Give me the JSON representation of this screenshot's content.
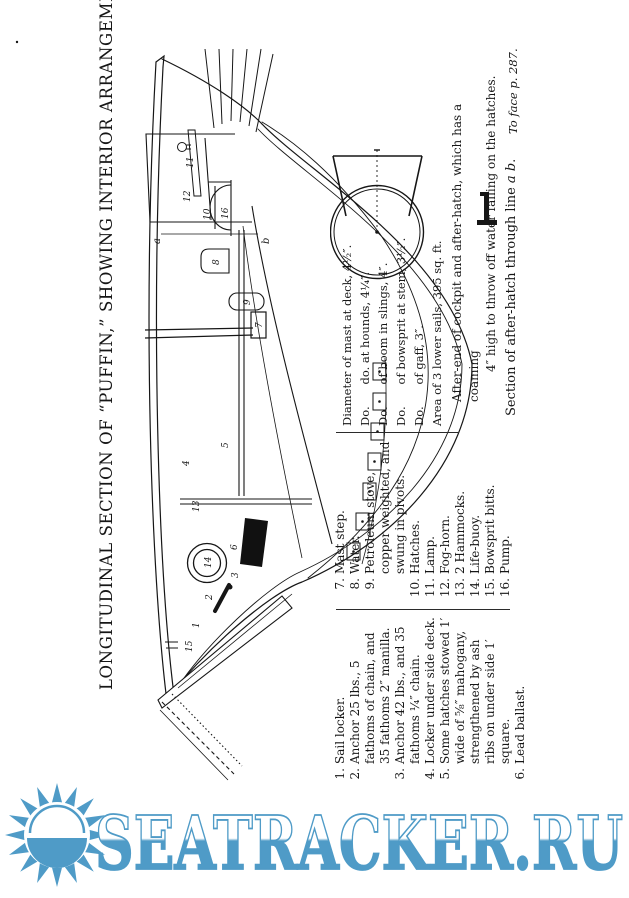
{
  "page": {
    "title": "LONGITUDINAL SECTION OF “PUFFIN,” SHOWING INTERIOR ARRANGEMENTS.",
    "footer_note": "To face p. 287."
  },
  "dimensions_block": {
    "lines": [
      "Diameter of mast at deck, 4½″.",
      "Do.      do. at hounds, 4¼″.",
      "Do.      of boom in slings, 4″.",
      "Do.      of bowsprit at stem, 3½″.",
      "Do.      of gaff, 3″.",
      "Area of 3 lower sails, 395 sq. ft."
    ]
  },
  "cockpit_note": {
    "line1": "After-end of cockpit and after-hatch, which has a coaming",
    "line2": "4″ high to throw off water falling on the hatches."
  },
  "section_caption": {
    "pre": "Section of after-hatch through line ",
    "ab": "a b",
    "end": "."
  },
  "legend": {
    "left": [
      {
        "num": "1.",
        "text": "Sail locker."
      },
      {
        "num": "2.",
        "text": "Anchor 25 lbs., 5 fathoms of chain, and 35 fathoms 2″ manilla."
      },
      {
        "num": "3.",
        "text": "Anchor 42 lbs., and 35 fathoms ¼″ chain."
      },
      {
        "num": "4.",
        "text": "Locker under side deck."
      },
      {
        "num": "5.",
        "text": "Some hatches stowed 1′ wide of ⅝″ mahogany, strengthened by ash ribs on under side 1′ square."
      },
      {
        "num": "6.",
        "text": "Lead ballast."
      }
    ],
    "right": [
      {
        "num": "7.",
        "text": "Mast step."
      },
      {
        "num": "8.",
        "text": "Water."
      },
      {
        "num": "9.",
        "text": "Petroleum stove, copper weighted, and swung in pivots."
      },
      {
        "num": "10.",
        "text": "Hatches."
      },
      {
        "num": "11.",
        "text": "Lamp."
      },
      {
        "num": "12.",
        "text": "Fog-horn."
      },
      {
        "num": "13.",
        "text": "2 Hammocks."
      },
      {
        "num": "14.",
        "text": "Life-buoy."
      },
      {
        "num": "15.",
        "text": "Bowsprit bitts."
      },
      {
        "num": "16.",
        "text": "Pump."
      }
    ]
  },
  "drawing": {
    "part_labels": {
      "n1": "1",
      "n2": "2",
      "n3": "3",
      "n4": "4",
      "n5": "5",
      "n6": "6",
      "n7": "7",
      "n8": "8",
      "n9": "9",
      "n10": "10",
      "n11": "11",
      "n12": "12",
      "n13": "13",
      "n14": "14",
      "n15": "15",
      "n16": "16"
    },
    "section_line": {
      "a": "a",
      "b": "b"
    }
  },
  "watermark": {
    "text": "SEATRACKER.RU",
    "color": "#4f9bc7",
    "icon": "sun-over-sea-icon"
  }
}
